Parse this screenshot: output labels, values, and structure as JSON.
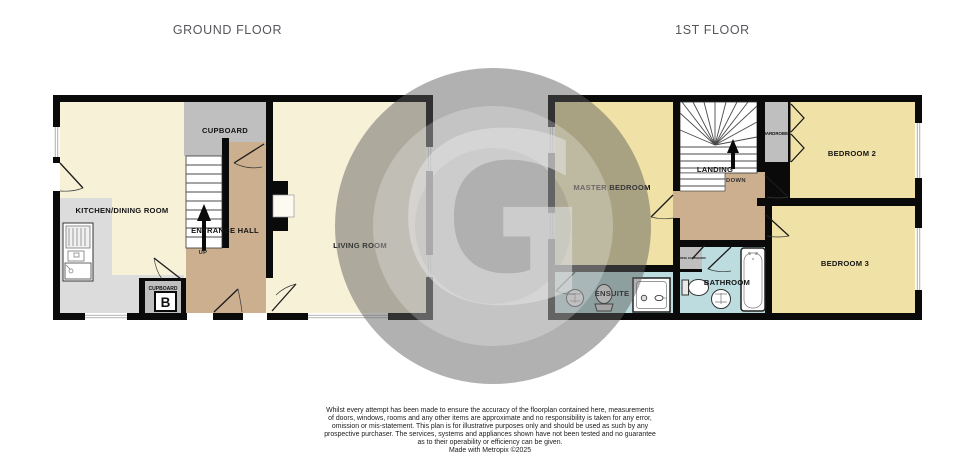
{
  "titles": {
    "ground_floor": "GROUND FLOOR",
    "first_floor": "1ST FLOOR"
  },
  "ground_floor": {
    "kitchen_label": "KITCHEN/DINING ROOM",
    "cupboard_label": "CUPBOARD",
    "entrance_hall_label": "ENTRANCE HALL",
    "living_room_label": "LIVING ROOM",
    "stairs_direction": "UP",
    "small_cupboard_label": "CUPBOARD",
    "boiler_label": "B"
  },
  "first_floor": {
    "master_bedroom_label": "MASTER BEDROOM",
    "landing_label": "LANDING",
    "stairs_direction": "DOWN",
    "wardrobe_label": "WARDROBE",
    "bedroom2_label": "BEDROOM 2",
    "bedroom3_label": "BEDROOM 3",
    "ensuite_label": "ENSUITE",
    "bathroom_label": "BATHROOM",
    "airing_cupboard_label": "AIRING CUPBOARD"
  },
  "watermark": {
    "letter": "G"
  },
  "disclaimer": {
    "lines": [
      "Whilst every attempt has been made to ensure the accuracy of the floorplan contained here, measurements",
      "of doors, windows, rooms and any other items are approximate and no responsibility is taken for any error,",
      "omission or mis-statement. This plan is for illustrative purposes only and should be used as such by any",
      "prospective purchaser. The services, systems and appliances shown have not been tested and no guarantee",
      "as to their operability or efficiency can be given.",
      "Made with Metropix ©2025"
    ]
  },
  "colors": {
    "wall": "#0a0a0a",
    "reception_cream": "#F7F1D8",
    "bedroom_yellow": "#F0E2A6",
    "hall_tan": "#CBAF8F",
    "storage_gray": "#BFBFBF",
    "counter_gray": "#DCDCDC",
    "bath_blue": "#BCDCDF",
    "title_text": "#55575B",
    "watermark_gray": "#ACACAC"
  }
}
